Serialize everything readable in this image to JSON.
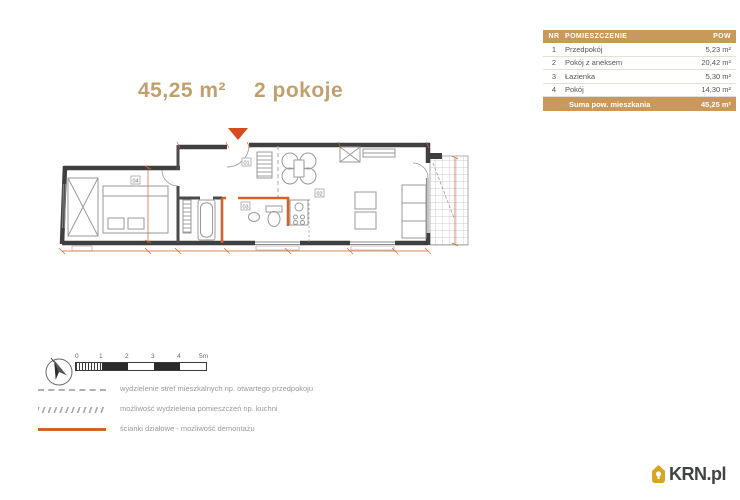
{
  "title": {
    "area": "45,25 m²",
    "rooms": "2 pokoje"
  },
  "rooms_table": {
    "headers": {
      "nr": "NR",
      "name": "POMIESZCZENIE",
      "area": "POW"
    },
    "rows": [
      {
        "nr": "1",
        "name": "Przedpokój",
        "area": "5,23 m²"
      },
      {
        "nr": "2",
        "name": "Pokój z aneksem",
        "area": "20,42 m²"
      },
      {
        "nr": "3",
        "name": "Łazienka",
        "area": "5,30 m²"
      },
      {
        "nr": "4",
        "name": "Pokój",
        "area": "14,30 m²"
      }
    ],
    "summary": {
      "label": "Suma pow. mieszkania",
      "value": "45,25 m²"
    }
  },
  "floorplan": {
    "room_labels": {
      "hall": "01",
      "living": "02",
      "bath": "03",
      "bedroom": "04"
    }
  },
  "scalebar": {
    "ticks": [
      "0",
      "1",
      "2",
      "3",
      "4",
      "5m"
    ]
  },
  "legend": {
    "items": [
      {
        "label": "wydzielenie stref mieszkalnych np. otwartego przedpokoju"
      },
      {
        "label": "możliwość wydzielenia pomieszczeń np. kuchni"
      },
      {
        "label": "ścianki działowe - możliwość demontażu"
      }
    ]
  },
  "logo": {
    "text": "KRN.pl"
  },
  "colors": {
    "accent_tan": "#c9995c",
    "title_tan": "#c2a06d",
    "wall": "#3f3f3f",
    "partition_orange": "#d2622a",
    "entrance_red": "#d84a1b",
    "legend_text": "#9a9a9a",
    "logo_gold": "#d9a520"
  }
}
